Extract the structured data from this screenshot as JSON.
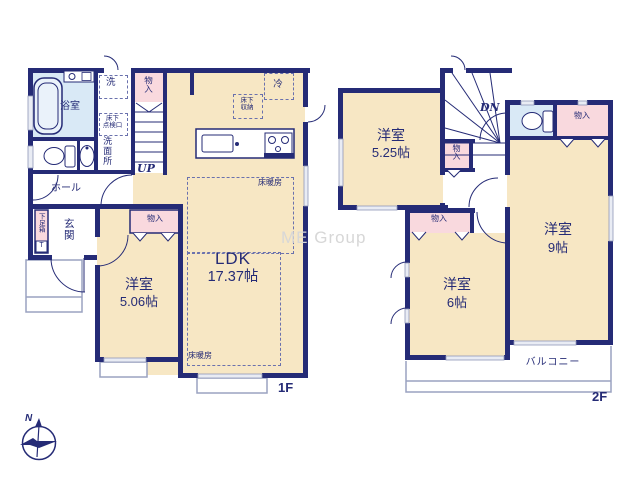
{
  "watermark": "ME Group",
  "compass": {
    "north": "N"
  },
  "floor1": {
    "floor_label": "1F",
    "bath": "浴室",
    "laundry": "洗",
    "washroom": "洗面所",
    "hatch_line1": "床下",
    "hatch_line2": "点検口",
    "hall": "ホール",
    "entrance": "玄関",
    "shoe_box": "下足箱",
    "shoe_box_door": "T",
    "closet": "物入",
    "stairs_up": "UP",
    "fridge": "冷",
    "storage_line1": "床下",
    "storage_line2": "収納",
    "floor_heating": "床暖房",
    "ldk_name": "LDK",
    "ldk_size": "17.37帖",
    "room1_name": "洋室",
    "room1_size": "5.06帖",
    "closet_room1": "物入"
  },
  "floor2": {
    "floor_label": "2F",
    "stairs_down": "DN",
    "room525_name": "洋室",
    "room525_size": "5.25帖",
    "room9_name": "洋室",
    "room9_size": "9帖",
    "room6_name": "洋室",
    "room6_size": "6帖",
    "closet_stairs": "物入",
    "closet_r9": "物入",
    "closet_r6": "物入",
    "balcony": "バルコニー"
  }
}
